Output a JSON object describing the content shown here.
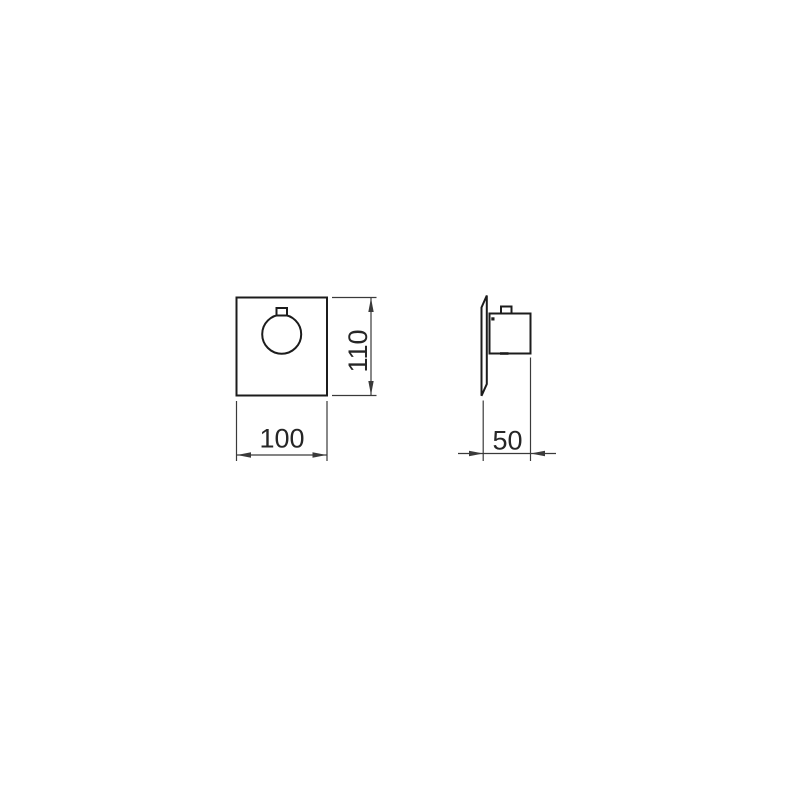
{
  "drawing": {
    "kind": "technical-drawing-2-views",
    "front_view": {
      "width_label": "100",
      "height_label": "110"
    },
    "side_view": {
      "depth_label": "50"
    },
    "colors": {
      "background": "#ffffff",
      "part_outline": "#1c1c1c",
      "dimension_lines": "#3a3a3a",
      "dimension_text": "#262626"
    }
  }
}
